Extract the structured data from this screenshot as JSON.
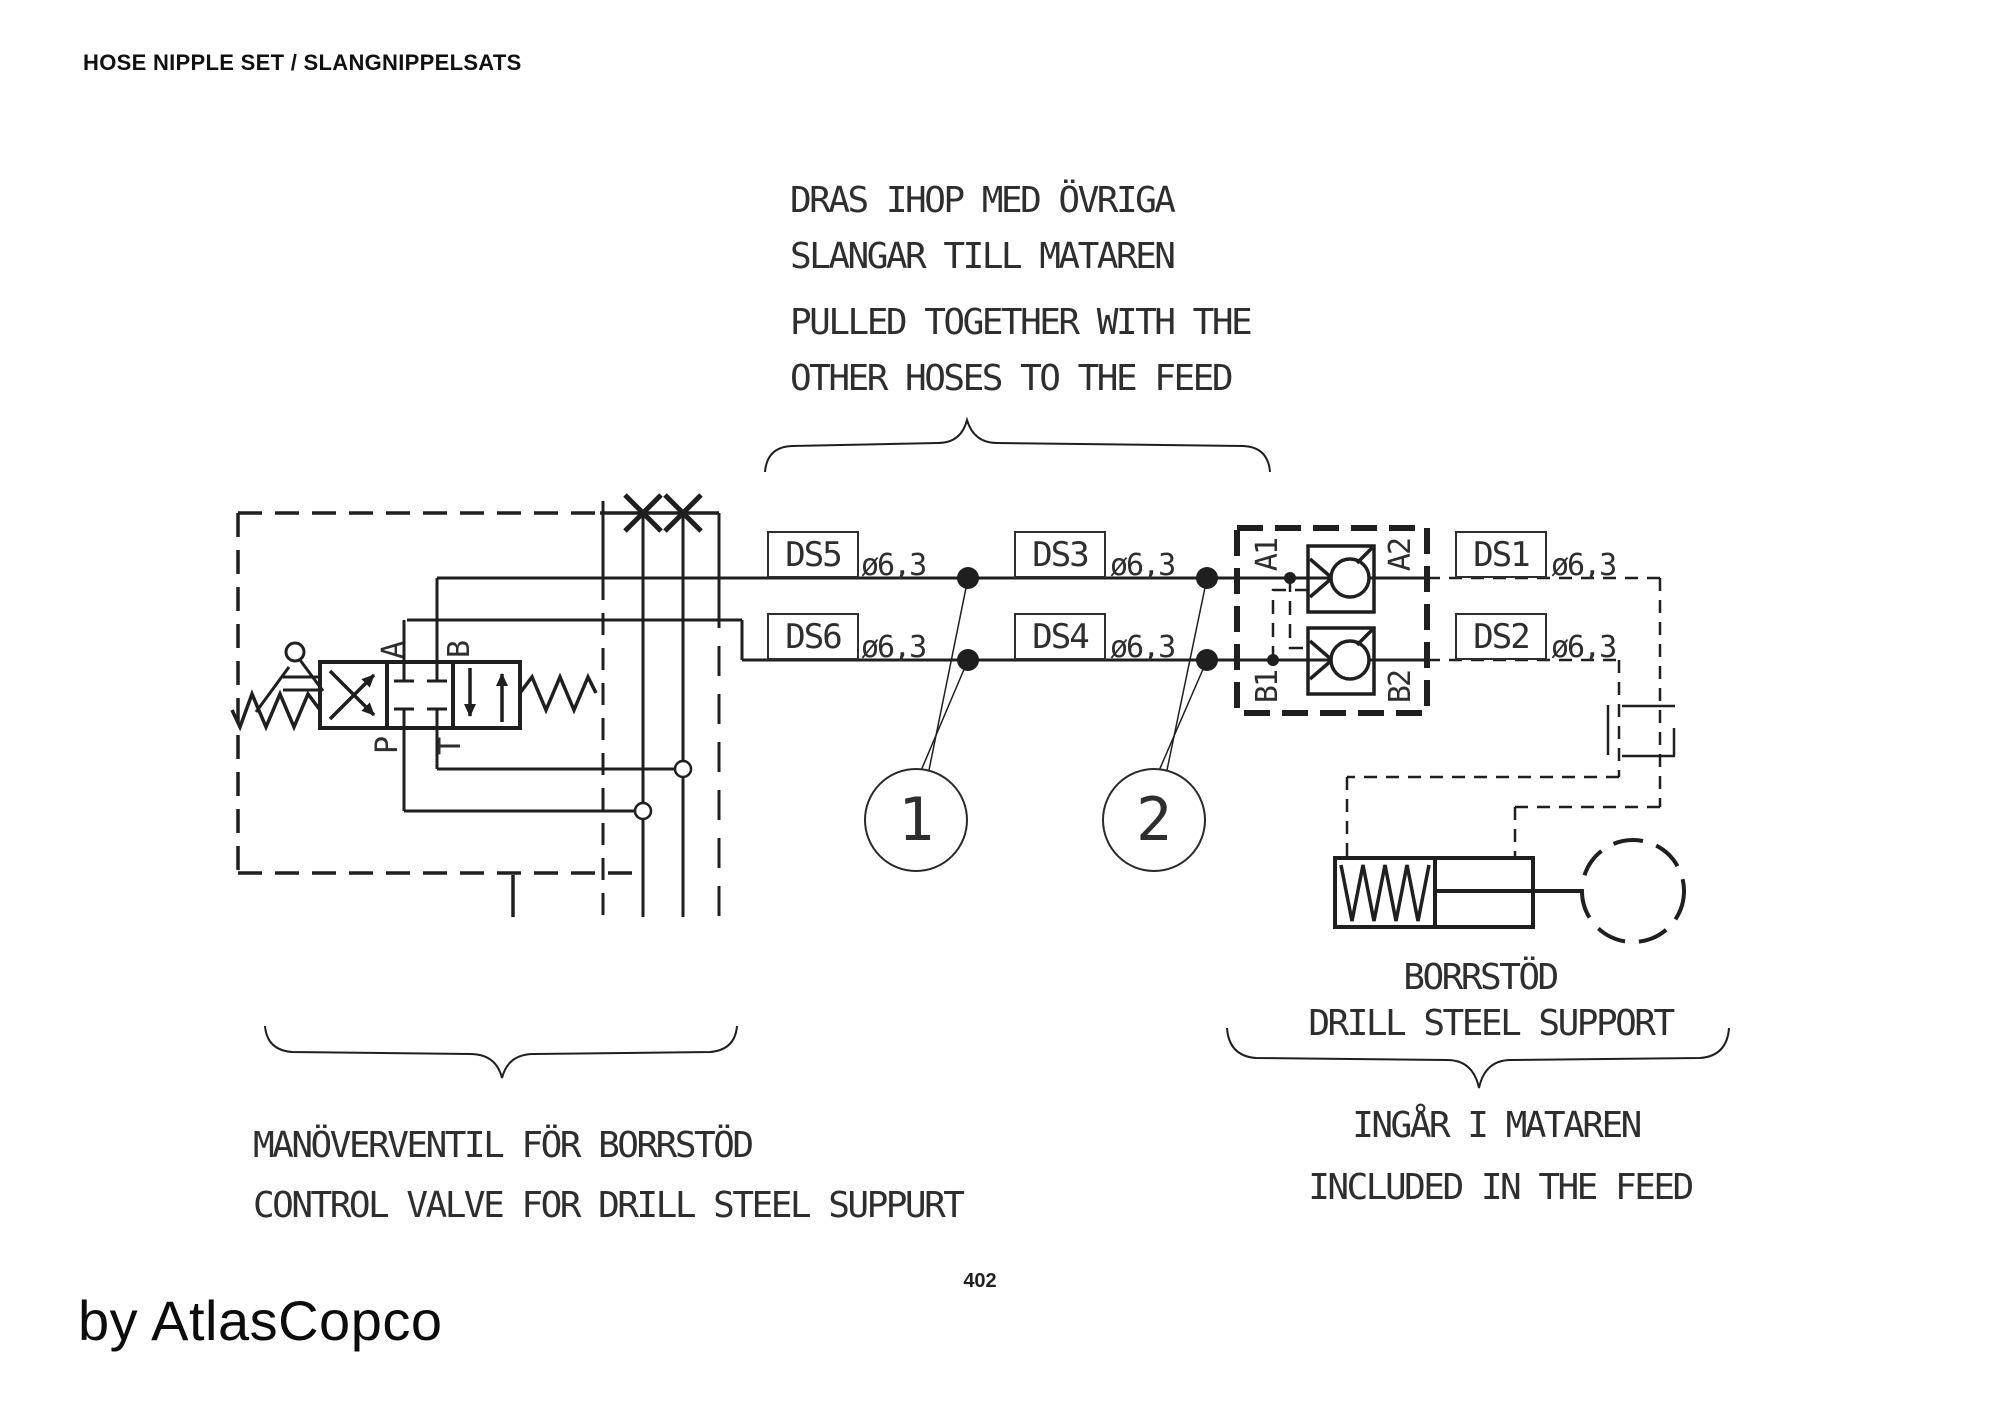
{
  "page": {
    "title": "HOSE NIPPLE SET / SLANGNIPPELSATS",
    "page_number": "402",
    "watermark": "by AtlasCopco"
  },
  "notes": {
    "pulled_sv_line1": "DRAS IHOP MED ÖVRIGA",
    "pulled_sv_line2": "SLANGAR TILL MATAREN",
    "pulled_en_line1": "PULLED TOGETHER WITH THE",
    "pulled_en_line2": "OTHER HOSES TO THE FEED",
    "valve_sv": "MANÖVERVENTIL FÖR BORRSTÖD",
    "valve_en": "CONTROL VALVE FOR DRILL STEEL SUPPURT",
    "support_sv": "BORRSTÖD",
    "support_en": "DRILL STEEL SUPPORT",
    "feed_sv": "INGÅR I MATAREN",
    "feed_en": "INCLUDED IN THE FEED"
  },
  "hoses": {
    "ds1": {
      "label": "DS1",
      "size": "ø6,3"
    },
    "ds2": {
      "label": "DS2",
      "size": "ø6,3"
    },
    "ds3": {
      "label": "DS3",
      "size": "ø6,3"
    },
    "ds4": {
      "label": "DS4",
      "size": "ø6,3"
    },
    "ds5": {
      "label": "DS5",
      "size": "ø6,3"
    },
    "ds6": {
      "label": "DS6",
      "size": "ø6,3"
    }
  },
  "ports": {
    "a": "A",
    "b": "B",
    "p": "P",
    "t": "T",
    "a1": "A1",
    "a2": "A2",
    "b1": "B1",
    "b2": "B2"
  },
  "callouts": {
    "c1": "1",
    "c2": "2"
  },
  "colors": {
    "line": "#1f1f1f",
    "background": "#ffffff"
  }
}
